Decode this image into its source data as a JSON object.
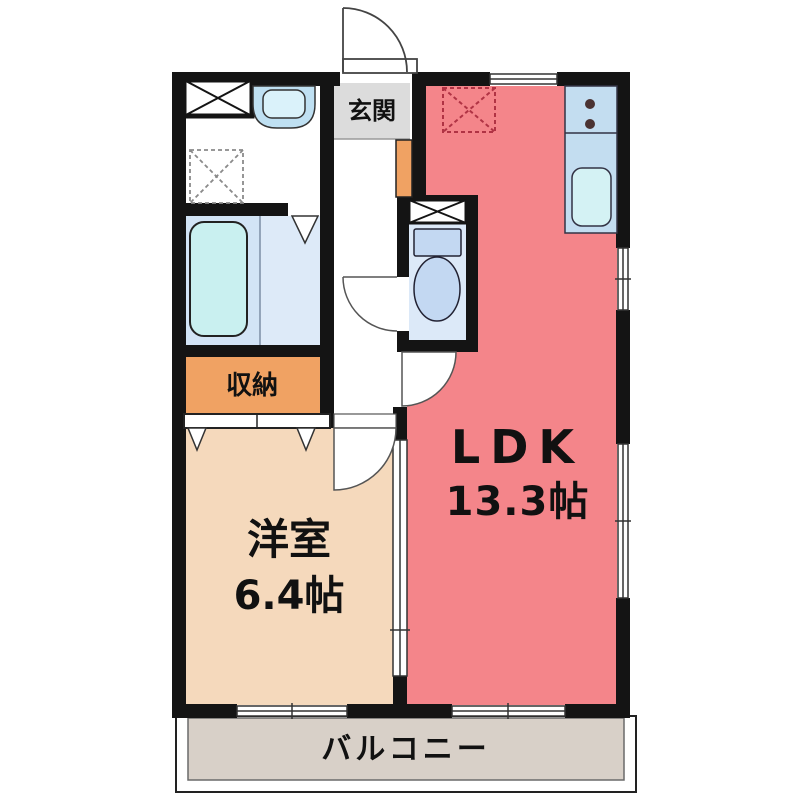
{
  "plan_title": "1LDK apartment floor plan",
  "rooms": {
    "entrance": {
      "label": "玄関"
    },
    "storage": {
      "label": "収納"
    },
    "western_room": {
      "label": "洋室",
      "size": "6.4帖"
    },
    "ldk": {
      "label": "LDK",
      "size": "13.3帖"
    },
    "balcony": {
      "label": "バルコニー"
    }
  },
  "fixtures": [
    "closet-x-box",
    "washbasin",
    "washing-machine-space",
    "bathtub",
    "bath-folding-door",
    "toilet",
    "toilet-shelf-x-box",
    "shoe-cabinet",
    "refrigerator-space",
    "kitchen-counter",
    "stove-burners",
    "kitchen-sink",
    "entrance-door",
    "toilet-door",
    "ldk-door",
    "western-room-door",
    "closet-folding-doors",
    "sliding-partition",
    "windows"
  ],
  "colors": {
    "wall": "#141414",
    "ldk_fill": "#f4858a",
    "western_room_fill": "#f5d9bc",
    "storage_fill": "#f0a263",
    "entrance_fill": "#dcdcdc",
    "balcony_fill": "#d8d0c8",
    "bathroom_floor": "#d2e4f6",
    "toilet_floor": "#dce9f8",
    "fixture_blue": "#c3ddf0",
    "tub_cyan": "#c9f0f0",
    "dashed_red": "#b03344",
    "text": "#111111"
  }
}
